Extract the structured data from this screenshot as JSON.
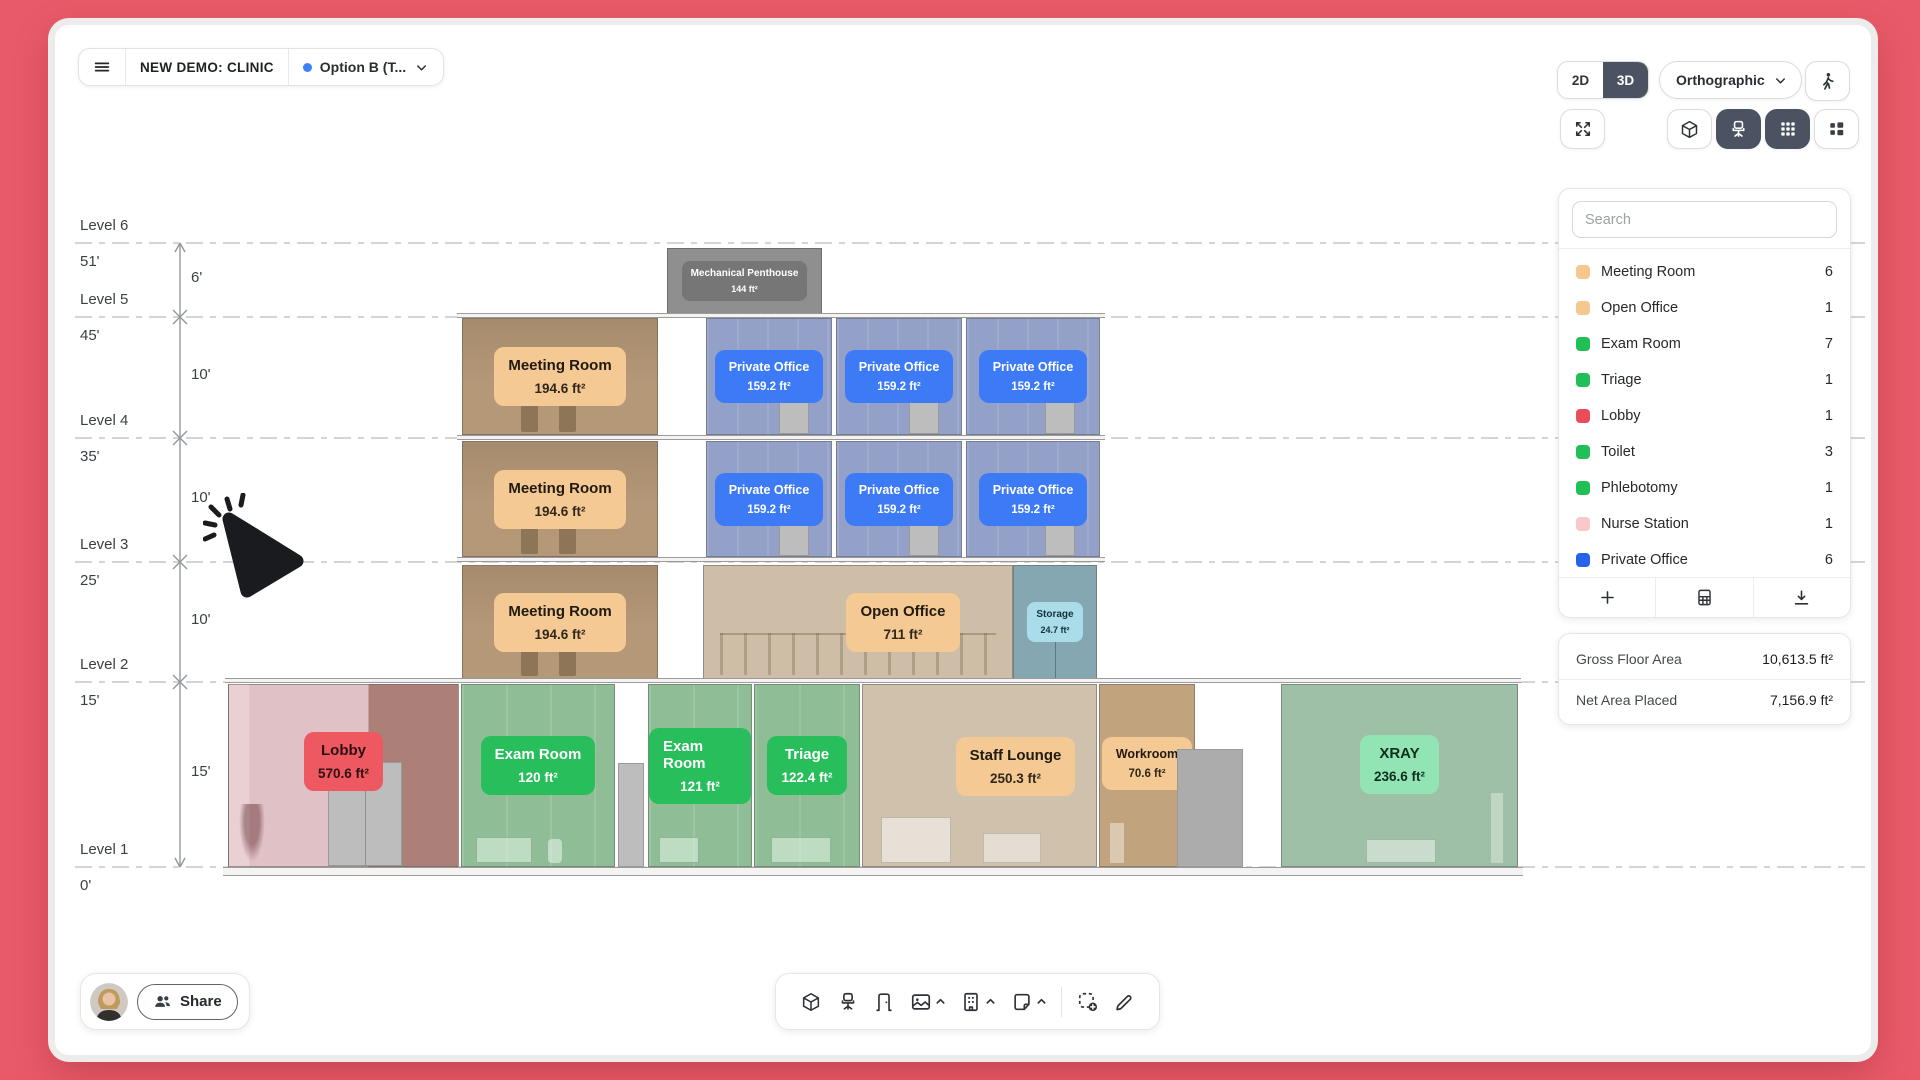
{
  "frame": {
    "background": "#E85A69"
  },
  "header": {
    "title": "NEW DEMO: CLINIC",
    "version": {
      "label": "Option B (T...",
      "dot_color": "#3B82F6"
    }
  },
  "view_controls": {
    "mode_2d": "2D",
    "mode_3d": "3D",
    "active_mode": "3D",
    "projection": "Orthographic",
    "icons": [
      "walk-icon",
      "fullscreen-icon",
      "cube-icon",
      "office-chair-icon",
      "grid-icon",
      "layout-tiles-icon"
    ]
  },
  "sidebar": {
    "search_placeholder": "Search",
    "rooms": [
      {
        "label": "Meeting Room",
        "count": 6,
        "color": "#F6C88F"
      },
      {
        "label": "Open Office",
        "count": 1,
        "color": "#F6C88F"
      },
      {
        "label": "Exam Room",
        "count": 7,
        "color": "#21BF58"
      },
      {
        "label": "Triage",
        "count": 1,
        "color": "#21BF58"
      },
      {
        "label": "Lobby",
        "count": 1,
        "color": "#EA4D5A"
      },
      {
        "label": "Toilet",
        "count": 3,
        "color": "#21BF58"
      },
      {
        "label": "Phlebotomy",
        "count": 1,
        "color": "#21BF58"
      },
      {
        "label": "Nurse Station",
        "count": 1,
        "color": "#F9C8CB"
      },
      {
        "label": "Private Office",
        "count": 6,
        "color": "#2563EC"
      }
    ],
    "footer_icons": [
      "add-icon",
      "spreadsheet-icon",
      "download-icon"
    ],
    "stats": [
      {
        "label": "Gross Floor Area",
        "value": "10,613.5 ft²"
      },
      {
        "label": "Net Area Placed",
        "value": "7,156.9 ft²"
      }
    ]
  },
  "section": {
    "levels": [
      {
        "name": "Level 6",
        "elevation": "51'"
      },
      {
        "name": "Level 5",
        "elevation": "45'"
      },
      {
        "name": "Level 4",
        "elevation": "35'"
      },
      {
        "name": "Level 3",
        "elevation": "25'"
      },
      {
        "name": "Level 2",
        "elevation": "15'"
      },
      {
        "name": "Level 1",
        "elevation": "0'"
      }
    ],
    "spans": [
      "6'",
      "10'",
      "10'",
      "10'",
      "15'"
    ],
    "floors": [
      {
        "rooms": [
          {
            "name": "Mechanical Penthouse",
            "area": "144 ft²"
          }
        ]
      },
      {
        "rooms": [
          {
            "name": "Meeting Room",
            "area": "194.6 ft²"
          },
          {
            "name": "Private Office",
            "area": "159.2 ft²"
          },
          {
            "name": "Private Office",
            "area": "159.2 ft²"
          },
          {
            "name": "Private Office",
            "area": "159.2 ft²"
          }
        ]
      },
      {
        "rooms": [
          {
            "name": "Meeting Room",
            "area": "194.6 ft²"
          },
          {
            "name": "Private Office",
            "area": "159.2 ft²"
          },
          {
            "name": "Private Office",
            "area": "159.2 ft²"
          },
          {
            "name": "Private Office",
            "area": "159.2 ft²"
          }
        ]
      },
      {
        "rooms": [
          {
            "name": "Meeting Room",
            "area": "194.6 ft²"
          },
          {
            "name": "Open Office",
            "area": "711 ft²"
          },
          {
            "name": "Storage",
            "area": "24.7 ft²"
          }
        ]
      },
      {
        "rooms": [
          {
            "name": "Lobby",
            "area": "570.6 ft²"
          },
          {
            "name": "Exam Room",
            "area": "120 ft²"
          },
          {
            "name": "Exam Room",
            "area": "121 ft²"
          },
          {
            "name": "Triage",
            "area": "122.4 ft²"
          },
          {
            "name": "Staff Lounge",
            "area": "250.3 ft²"
          },
          {
            "name": "Workroom",
            "area": "70.6 ft²"
          },
          {
            "name": "XRAY",
            "area": "236.6 ft²"
          }
        ]
      }
    ]
  },
  "bottom_toolbar": {
    "icons": [
      "cube-icon",
      "office-chair-icon",
      "door-icon",
      "image-icon",
      "building-icon",
      "note-icon",
      "select-add-icon",
      "pen-icon"
    ]
  },
  "share": {
    "label": "Share"
  }
}
